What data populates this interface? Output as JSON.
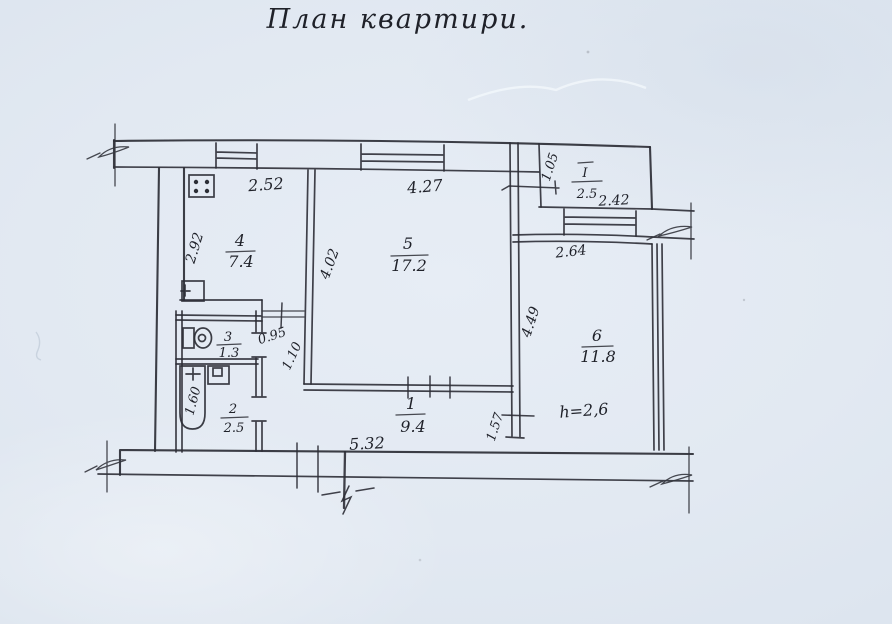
{
  "title": "План квартири.",
  "rooms": {
    "corridor": {
      "num": "1",
      "area": "9.4"
    },
    "bath": {
      "num": "2",
      "area": "2.5"
    },
    "wc": {
      "num": "3",
      "area": "1.3"
    },
    "kitchen": {
      "num": "4",
      "area": "7.4"
    },
    "living": {
      "num": "5",
      "area": "17.2"
    },
    "bedroom": {
      "num": "6",
      "area": "11.8"
    },
    "balcony": {
      "num": "I",
      "area": "2.5"
    }
  },
  "dimensions": {
    "kitchen_width": "2.52",
    "kitchen_depth": "2.92",
    "living_width": "4.27",
    "living_depth": "4.02",
    "balcony_offset": "1.05",
    "balcony_width": "2.42",
    "bedroom_width": "2.64",
    "bedroom_depth": "4.49",
    "hall_opening": "0.95",
    "hall_width": "1.10",
    "bedroom_door": "1.57",
    "bottom_width": "5.32",
    "bathtub_length": "1.60",
    "ceiling_height": "h=2,6"
  }
}
